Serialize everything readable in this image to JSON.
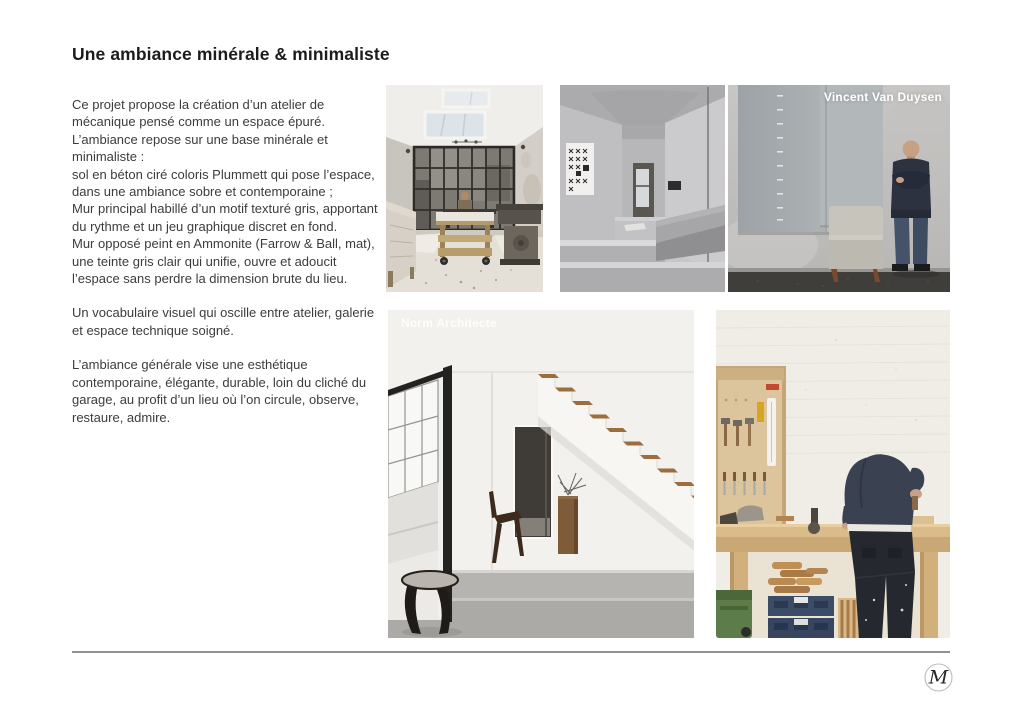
{
  "page": {
    "title": "Une ambiance minérale & minimaliste",
    "colors": {
      "background": "#ffffff",
      "title_text": "#1c1c1c",
      "body_text": "#3c3c3c",
      "rule": "#919191",
      "caption_text": "#ffffff"
    }
  },
  "content": {
    "paragraphs": [
      "Ce projet propose la création d’un atelier de mécanique pensé comme un espace  épuré.\nL’ambiance repose sur une base minérale et minimaliste :\nsol en béton ciré coloris Plummett qui pose l’espace, dans une ambiance sobre et contemporaine ;\nMur principal habillé d’un motif texturé gris, apportant du rythme et un jeu graphique discret en fond.\nMur opposé peint en Ammonite (Farrow & Ball, mat), une teinte gris clair qui unifie, ouvre et adoucit l’espace sans perdre la dimension brute du lieu.",
      "Un vocabulaire visuel qui oscille entre atelier, galerie et espace technique soigné.",
      "L’ambiance générale vise une esthétique contemporaine, élégante, durable, loin du cliché du garage, au profit d’un lieu où l’on circule, observe, restaure, admire."
    ]
  },
  "gallery": {
    "images": [
      {
        "id": "atelier",
        "label": "",
        "alt": "Atelier lumineux avec verrière et établi mobile"
      },
      {
        "id": "couloir",
        "label": "",
        "alt": "Couloir minéral en béton avec marches"
      },
      {
        "id": "portrait",
        "label": "Vincent Van Duysen",
        "alt": "Homme debout devant un mur gris avec fauteuil"
      },
      {
        "id": "escalier",
        "label": "Norm Architecte",
        "alt": "Escalier blanc aux marches en bois"
      },
      {
        "id": "etabli",
        "label": "",
        "alt": "Artisan penché sur un établi en bois"
      }
    ]
  },
  "footer": {
    "logo_monogram": "M"
  }
}
